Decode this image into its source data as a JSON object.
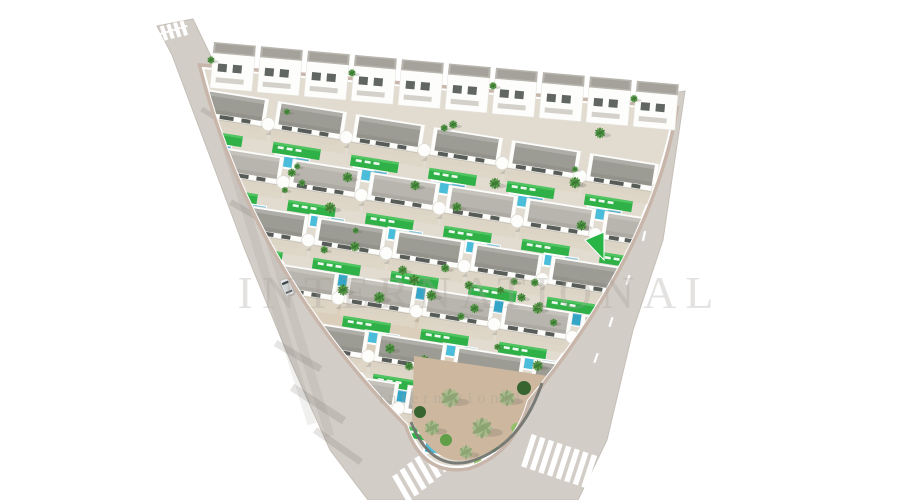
{
  "meta": {
    "title": "Aerial 3D render of a Mediterranean white-villa development with pools, palm trees and perimeter roads",
    "image_type": "architectural-render"
  },
  "canvas": {
    "width": 900,
    "height": 500,
    "background": "#ffffff"
  },
  "watermark": {
    "line1": "INTERNATIONAL",
    "line2": "international"
  },
  "palette": {
    "background": "#ffffff",
    "road": "#d3cdc7",
    "road_edge": "#c5bfb8",
    "sidewalk": "#c8b6ab",
    "ground": "#e1dbd0",
    "dirt": "#cdb89f",
    "dirt_light": "#d9cbb4",
    "house_white": "#fdfdfb",
    "house_shade": "#e7e5df",
    "roof_dark": "#9d9c94",
    "roof_light": "#b7b5ad",
    "window_dark": "#39403c",
    "terrace": "#ded6c6",
    "lawn": "#2fb148",
    "lawn_light": "#58c968",
    "pool": "#49bdd9",
    "pool_deep": "#2292b8",
    "palm_dark": "#3b7a33",
    "palm_mid": "#61a34e",
    "palm_sage": "#a7bc8c",
    "palm_sage_dark": "#8aa371",
    "bush_dark": "#2f6029",
    "bush_mid": "#5a9c43",
    "bush_light": "#90c06a",
    "shadow": "rgba(100,96,88,0.22)",
    "shadow_strong": "rgba(90,86,78,0.30)",
    "wall_dark": "#6f726d",
    "marking": "#ffffff",
    "car_body": "#e7e8e9",
    "car_glass": "#40474b"
  },
  "plot": {
    "outline": "M 203,68 L 674,110 Q 650,250 527,400 Q 512,452 468,466 Q 424,474 408,424 Q 255,270 203,68 Z",
    "tip_wall": "M 542,383 Q 520,448 468,462 Q 430,470 411,422",
    "dirt_tip": "M 414,356 L 548,376 Q 522,446 468,460 Q 434,466 412,420 Z",
    "dirt_mid": "M 300,290 L 420,310 L 470,380 L 340,360 Z"
  },
  "road": {
    "surface": "M 157,26 L 193,19 L 232,100 L 648,138 L 656,96 L 685,91 L 663,240 L 633,330 L 607,440 L 578,500 L 368,500 L 330,450 L 290,360 L 245,250 L 172,55 Z",
    "curb_shadow": "M 672,112 Q 648,252 528,398",
    "tracks": [
      "M 208,84 Q 252,232 312,424",
      "M 222,80 Q 268,236 330,436"
    ],
    "dashes": [
      [
        663,
        152,
        100
      ],
      [
        654,
        194,
        101
      ],
      [
        644,
        236,
        103
      ],
      [
        628,
        280,
        106
      ],
      [
        611,
        322,
        108
      ],
      [
        596,
        358,
        110
      ]
    ],
    "stop_lines": {
      "right": [
        [
          659,
          122
        ],
        [
          665,
          121
        ],
        [
          671,
          120
        ]
      ],
      "left": [
        [
          163,
          33
        ],
        [
          170,
          31
        ],
        [
          177,
          29
        ],
        [
          184,
          27
        ]
      ]
    },
    "shadow_streaks": [
      [
        318,
        404,
        62,
        8,
        33
      ],
      [
        298,
        356,
        52,
        7,
        30
      ],
      [
        338,
        446,
        56,
        7,
        35
      ],
      [
        248,
        212,
        40,
        6,
        30
      ],
      [
        216,
        118,
        34,
        5,
        32
      ]
    ]
  },
  "crosswalks": [
    {
      "x": 402,
      "y": 488,
      "count": 7,
      "sx": 7.4,
      "sy": -6.0,
      "len": 30,
      "w": 5.5,
      "rot": 60
    },
    {
      "x": 529,
      "y": 451,
      "count": 8,
      "sx": 8.6,
      "sy": 2.9,
      "len": 34,
      "w": 5.5,
      "rot": 108
    },
    {
      "x": 164,
      "y": 33,
      "count": 4,
      "sx": 6.6,
      "sy": -1.6,
      "len": 15,
      "w": 4,
      "rot": 72
    }
  ],
  "car": {
    "x": 287,
    "y": 287,
    "rot": -23
  },
  "skyline": {
    "x": 214,
    "y": 42,
    "dx": 47,
    "dy": 4.3,
    "count": 10,
    "rot": 5
  },
  "villa_rows": [
    {
      "x": 200,
      "y": 88,
      "count": 7,
      "variant": "A"
    },
    {
      "x": 215,
      "y": 146,
      "count": 7,
      "variant": "B"
    },
    {
      "x": 240,
      "y": 204,
      "count": 6,
      "variant": "A"
    },
    {
      "x": 270,
      "y": 262,
      "count": 5,
      "variant": "B"
    },
    {
      "x": 300,
      "y": 320,
      "count": 4,
      "variant": "A"
    },
    {
      "x": 330,
      "y": 372,
      "count": 3,
      "variant": "B"
    }
  ],
  "villa_step": {
    "dx": 78,
    "dy": 13,
    "rot": 9
  },
  "palms": {
    "count": 42,
    "seed": 11
  },
  "green_triangle": "585,240 604,232 604,260",
  "tip_flora": {
    "palms": [
      [
        450,
        398,
        2.1
      ],
      [
        482,
        428,
        2.3
      ],
      [
        507,
        398,
        1.8
      ],
      [
        432,
        428,
        1.7
      ],
      [
        466,
        452,
        1.5
      ]
    ],
    "bushes": [
      [
        524,
        388,
        7,
        "dark"
      ],
      [
        536,
        398,
        5,
        "mid"
      ],
      [
        420,
        412,
        6,
        "dark"
      ],
      [
        446,
        440,
        6,
        "mid"
      ],
      [
        500,
        452,
        5,
        "dark"
      ],
      [
        478,
        462,
        4,
        "light"
      ],
      [
        516,
        428,
        5,
        "light"
      ]
    ]
  }
}
